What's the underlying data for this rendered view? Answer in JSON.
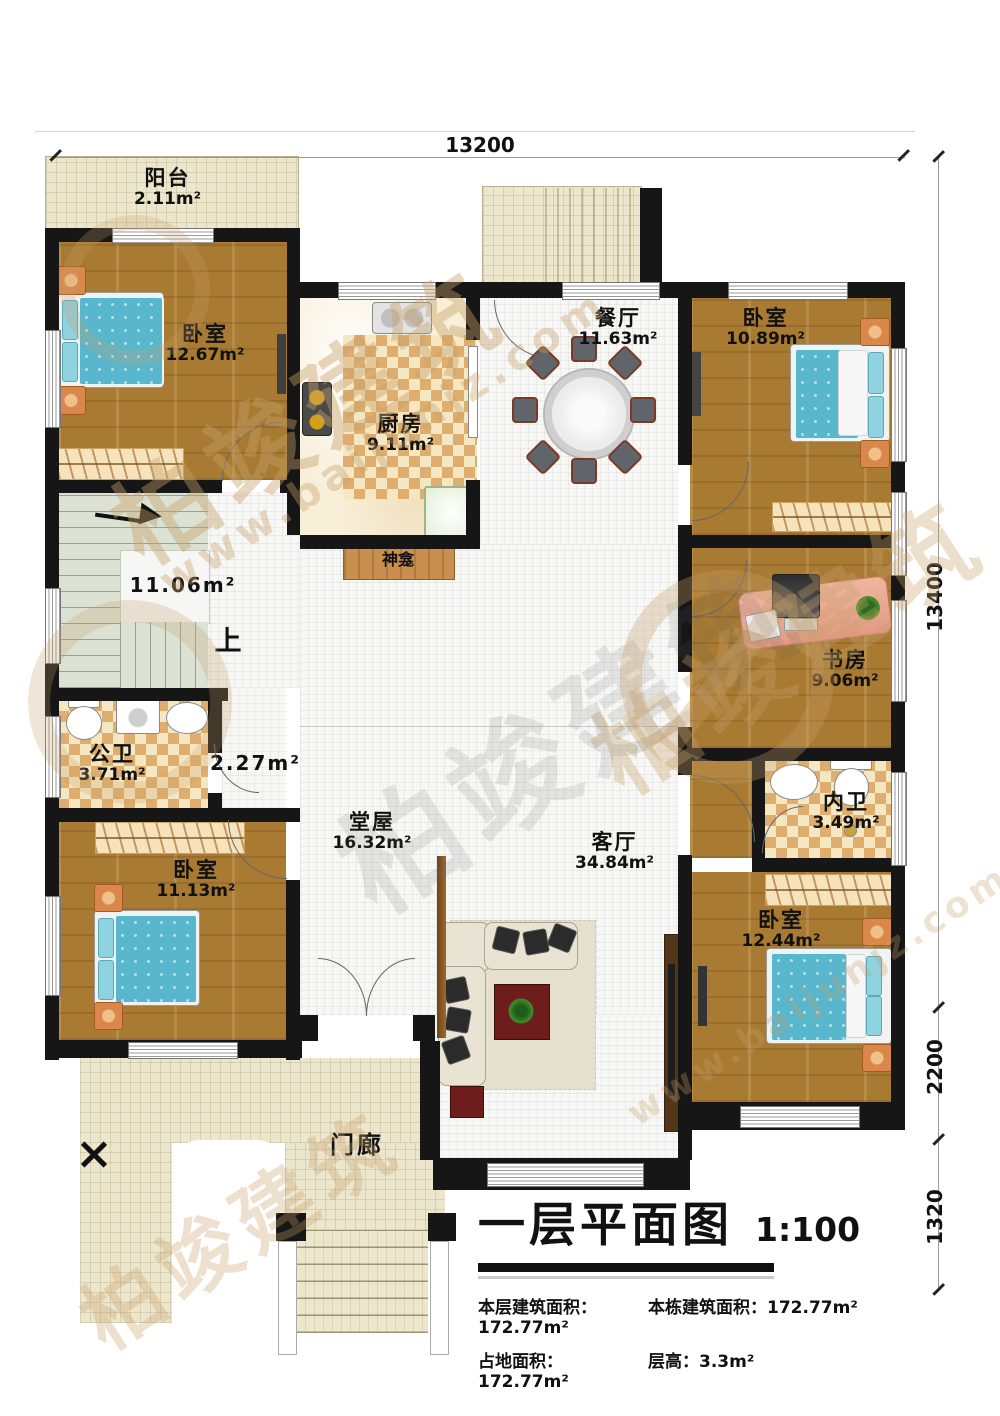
{
  "plan": {
    "title": "一层平面图",
    "scale": "1:100",
    "stats": {
      "floor_area_label": "本层建筑面积：",
      "floor_area_value": "172.77m²",
      "building_area_label": "本栋建筑面积：",
      "building_area_value": "172.77m²",
      "footprint_label": "占地面积：",
      "footprint_value": "172.77m²",
      "height_label": "层高：",
      "height_value": "3.3m²"
    }
  },
  "dimensions": {
    "top_width": "13200",
    "right_height": "13400",
    "right_lower": "2200",
    "right_bottom": "1320"
  },
  "rooms": {
    "balcony": {
      "name": "阳台",
      "area": "2.11m²"
    },
    "bedroom_tl": {
      "name": "卧室",
      "area": "12.67m²"
    },
    "kitchen": {
      "name": "厨房",
      "area": "9.11m²"
    },
    "dining": {
      "name": "餐厅",
      "area": "11.63m²"
    },
    "bedroom_tr": {
      "name": "卧室",
      "area": "10.89m²"
    },
    "study": {
      "name": "书房",
      "area": "9.06m²"
    },
    "stairs": {
      "area": "11.06m²",
      "up": "上"
    },
    "public_bath": {
      "name": "公卫",
      "area": "3.71m²"
    },
    "hallway": {
      "area": "2.27m²"
    },
    "hall": {
      "name": "堂屋",
      "area": "16.32m²"
    },
    "living": {
      "name": "客厅",
      "area": "34.84m²"
    },
    "inner_bath": {
      "name": "内卫",
      "area": "3.49m²"
    },
    "bedroom_bl": {
      "name": "卧室",
      "area": "11.13m²"
    },
    "bedroom_br": {
      "name": "卧室",
      "area": "12.44m²"
    },
    "shrine": {
      "name": "神龛"
    },
    "porch": {
      "name": "门廊"
    }
  },
  "watermark": {
    "brand": "柏竣建筑",
    "site": "www.baijunjz.com"
  },
  "colors": {
    "wall": "#161616",
    "wood_floor": "#a87a32",
    "bed_blue": "#58b7cc",
    "checker_tan": "#dfae6e",
    "stairs_green": "#dbe2d4",
    "outdoor_beige": "#ece6cc",
    "watermark_tan": "#c8a06a"
  }
}
